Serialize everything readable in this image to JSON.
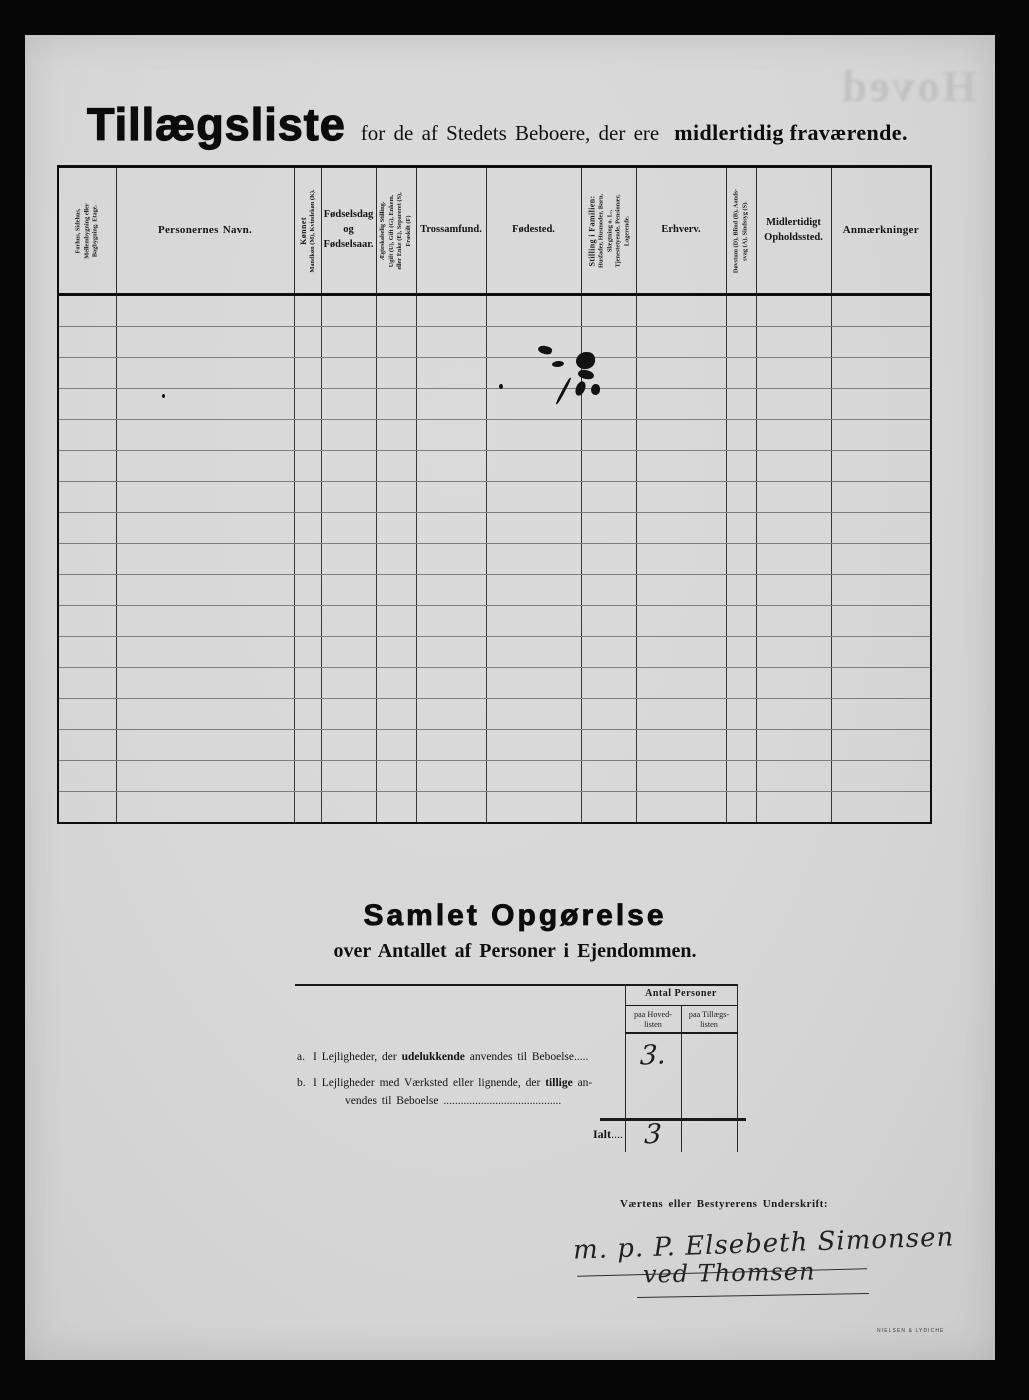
{
  "page": {
    "title_main": "Tillægsliste",
    "title_mid": "for de af Stedets Beboere, der ere",
    "title_bold": "midlertidig fraværende.",
    "ghost_text": "Hoved",
    "printer_mark": "NIELSEN & LYDICHE"
  },
  "table": {
    "row_count": 17,
    "columns": [
      {
        "id": "building",
        "width": 58,
        "rotated": true,
        "lines": [
          "Forhus, Sidehus,",
          "Mellembygning eller",
          "Bagbygning.    Etage."
        ]
      },
      {
        "id": "personernes-navn",
        "width": 178,
        "rotated": false,
        "bold": true,
        "label": "Personernes Navn."
      },
      {
        "id": "koennet",
        "width": 27,
        "rotated": true,
        "big_first": true,
        "lines": [
          "Kønnet",
          "Mandkøn (M), Kvindekøn (K)."
        ]
      },
      {
        "id": "foedselsdag",
        "width": 55,
        "rotated": false,
        "label": "Fødselsdag\nog\nFødselsaar."
      },
      {
        "id": "aegteskabelig-stilling",
        "width": 40,
        "rotated": true,
        "lines": [
          "Ægteskabelig Stilling.",
          "Ugift (U), Gift (G), Enkem.",
          "eller Enke (E), Separeret (S),",
          "Fraskilt (F)"
        ]
      },
      {
        "id": "trossamfund",
        "width": 70,
        "rotated": false,
        "label": "Trossamfund."
      },
      {
        "id": "foedested",
        "width": 95,
        "rotated": false,
        "label": "Fødested."
      },
      {
        "id": "stilling-i-familien",
        "width": 55,
        "rotated": true,
        "big_first": true,
        "lines": [
          "Stilling i Familien:",
          "Husfader, Husmoder, Barn,",
          "Slægtning o. L.,",
          "Tjenestetyende, Pensionær,",
          "Logerende."
        ]
      },
      {
        "id": "erhverv",
        "width": 90,
        "rotated": false,
        "label": "Erhverv."
      },
      {
        "id": "doevstum",
        "width": 30,
        "rotated": true,
        "lines": [
          "Døvstum (D), Blind (B), Aands-",
          "svag (A), Sindssyg (S)."
        ]
      },
      {
        "id": "midlertidigt-opholdssted",
        "width": 75,
        "rotated": false,
        "label": "Midlertidigt\nOpholdssted."
      },
      {
        "id": "anmaerkninger",
        "width": 100,
        "rotated": false,
        "bold": true,
        "label": "Anmærkninger"
      }
    ]
  },
  "summary": {
    "heading": "Samlet Opgørelse",
    "subheading": "over Antallet af Personer i Ejendommen.",
    "antal_header": "Antal Personer",
    "col_hoved": "paa Hoved-\nlisten",
    "col_tillaegs": "paa Tillægs-\nlisten",
    "row_a": {
      "marker": "a.",
      "pre": "I Lejligheder, der ",
      "bold": "udelukkende",
      "post": " anvendes til Beboelse",
      "dots": ".....",
      "value": "3."
    },
    "row_b": {
      "marker": "b.",
      "line1_pre": "I Lejligheder med Værksted eller lignende, der ",
      "line1_bold": "tillige",
      "line1_post": " an-",
      "line2": "vendes til Beboelse ",
      "line2_dots": ".........................................",
      "value": ""
    },
    "total": {
      "label": "Ialt",
      "dots": "....",
      "value": "3"
    }
  },
  "signature": {
    "label": "Værtens eller Bestyrerens Underskrift:",
    "line1": "m. p. P. Elsebeth Simonsen",
    "line2": "ved Thomsen"
  }
}
